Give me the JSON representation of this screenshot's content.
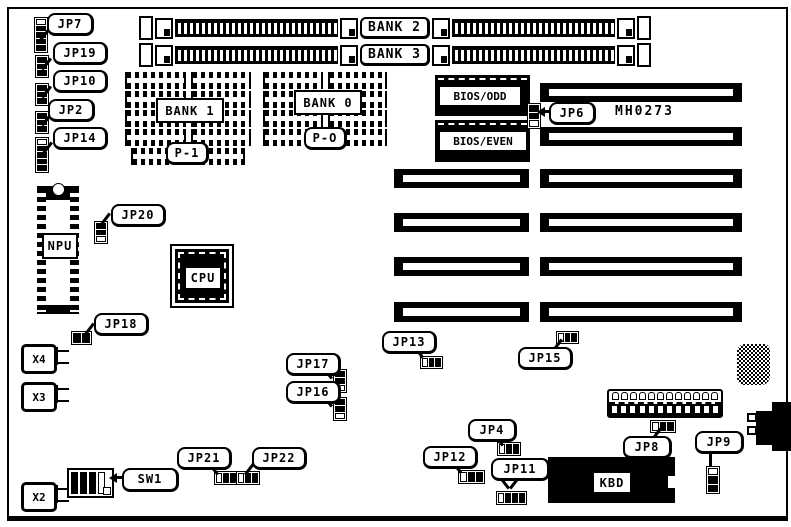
{
  "board": {
    "code": "MH0273"
  },
  "memory": {
    "bank2": "BANK 2",
    "bank3": "BANK 3",
    "bank1": "BANK 1",
    "bank0": "BANK 0",
    "p1": "P-1",
    "p0": "P-O"
  },
  "chips": {
    "bios_odd": "BIOS/ODD",
    "bios_even": "BIOS/EVEN",
    "npu": "NPU",
    "cpu": "CPU",
    "kbd": "KBD"
  },
  "crystals": {
    "x4": "X4",
    "x3": "X3",
    "x2": "X2"
  },
  "switches": {
    "sw1": "SW1"
  },
  "jumpers": {
    "jp7": "JP7",
    "jp19": "JP19",
    "jp10": "JP10",
    "jp2": "JP2",
    "jp14": "JP14",
    "jp20": "JP20",
    "jp18": "JP18",
    "jp6": "JP6",
    "jp17": "JP17",
    "jp16": "JP16",
    "jp13": "JP13",
    "jp15": "JP15",
    "jp21": "JP21",
    "jp22": "JP22",
    "jp4": "JP4",
    "jp12": "JP12",
    "jp11": "JP11",
    "jp8": "JP8",
    "jp9": "JP9"
  },
  "colors": {
    "ink": "#000000",
    "paper": "#ffffff"
  }
}
